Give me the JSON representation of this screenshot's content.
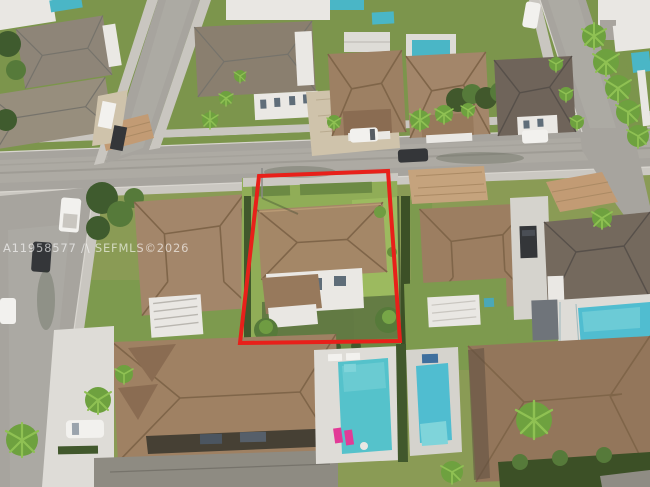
{
  "photo": {
    "kind_label": "aerial-neighborhood-listing-photo",
    "watermark": "A11958577 /\\ SEFMLS©2026"
  },
  "annotation": {
    "label": "highlighted-property-boundary",
    "boundary_color": "#e8201a"
  },
  "colors": {
    "roof_tan": "#a48767",
    "roof_dark": "#74695d",
    "roof_gray": "#8e8b82",
    "lawn_green": "#90ad57",
    "pool_teal": "#55c2cb",
    "street_gray": "#a7a49e",
    "sidewalk": "#c9c6c0",
    "paver_tan": "#c29b74",
    "lounger_pink": "#e23b97",
    "wall_white": "#eae8e4"
  }
}
